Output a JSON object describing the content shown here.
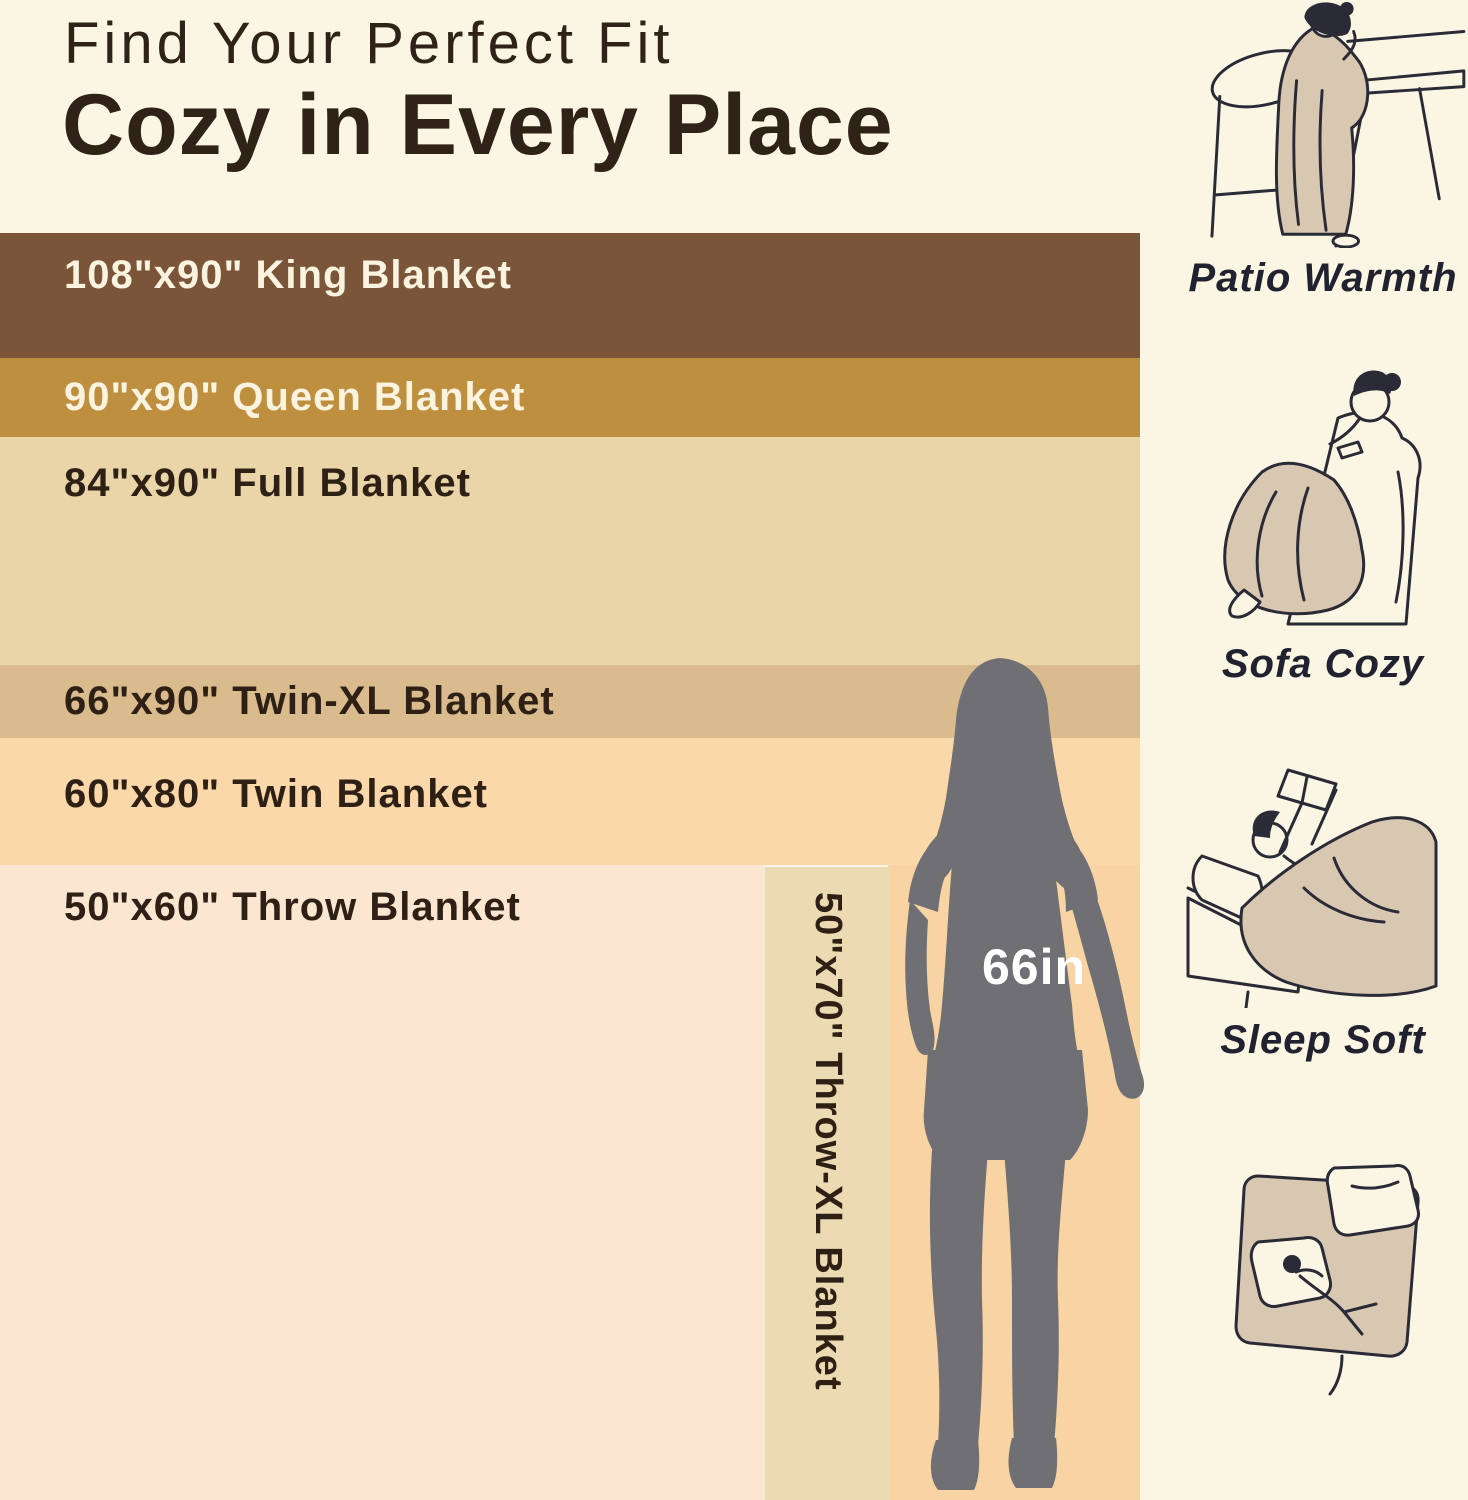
{
  "title": {
    "line1": "Find Your Perfect Fit",
    "line2": "Cozy in Every Place"
  },
  "bands": [
    {
      "type": "King",
      "size": "108\"x90\"",
      "label": "108\"x90\" King Blanket",
      "color": "#7B5539",
      "text_color": "#FAF3DF"
    },
    {
      "type": "Queen",
      "size": "90\"x90\"",
      "label": "90\"x90\" Queen Blanket",
      "color": "#BF8F40",
      "text_color": "#FAF3DF"
    },
    {
      "type": "Full",
      "size": "84\"x90\"",
      "label": "84\"x90\" Full Blanket",
      "color": "#EAD5A9",
      "text_color": "#2E2014"
    },
    {
      "type": "Twin-XL",
      "size": "66\"x90\"",
      "label": "66\"x90\" Twin-XL Blanket",
      "color": "#D9BB8E",
      "text_color": "#2E2014"
    },
    {
      "type": "Twin",
      "size": "60\"x80\"",
      "label": "60\"x80\" Twin Blanket",
      "color": "#FBD8A9",
      "text_color": "#2E2014"
    },
    {
      "type": "Throw",
      "size": "50\"x60\"",
      "label": "50\"x60\" Throw Blanket",
      "color": "#FBE7D1",
      "text_color": "#2E2014"
    }
  ],
  "throw_xl": {
    "type": "Throw-XL",
    "size": "50\"x70\"",
    "label": "50\"x70\" Throw-XL Blanket",
    "color": "#ECDAB2",
    "text_color": "#2E2014"
  },
  "figure": {
    "height_label": "66in",
    "silhouette_color": "#706F74",
    "label_color": "#FFFFFF"
  },
  "right_panel": {
    "scenes": [
      {
        "caption": "Patio Warmth"
      },
      {
        "caption": "Sofa Cozy"
      },
      {
        "caption": "Sleep Soft"
      },
      {
        "caption": ""
      }
    ]
  },
  "colors": {
    "background": "#FAF6E3",
    "title": "#2F2217",
    "caption": "#20222F",
    "line_art": "#2A2B36",
    "blanket_fill": "#D8C8B2",
    "lower_right_patch": "#F8D3A4"
  }
}
